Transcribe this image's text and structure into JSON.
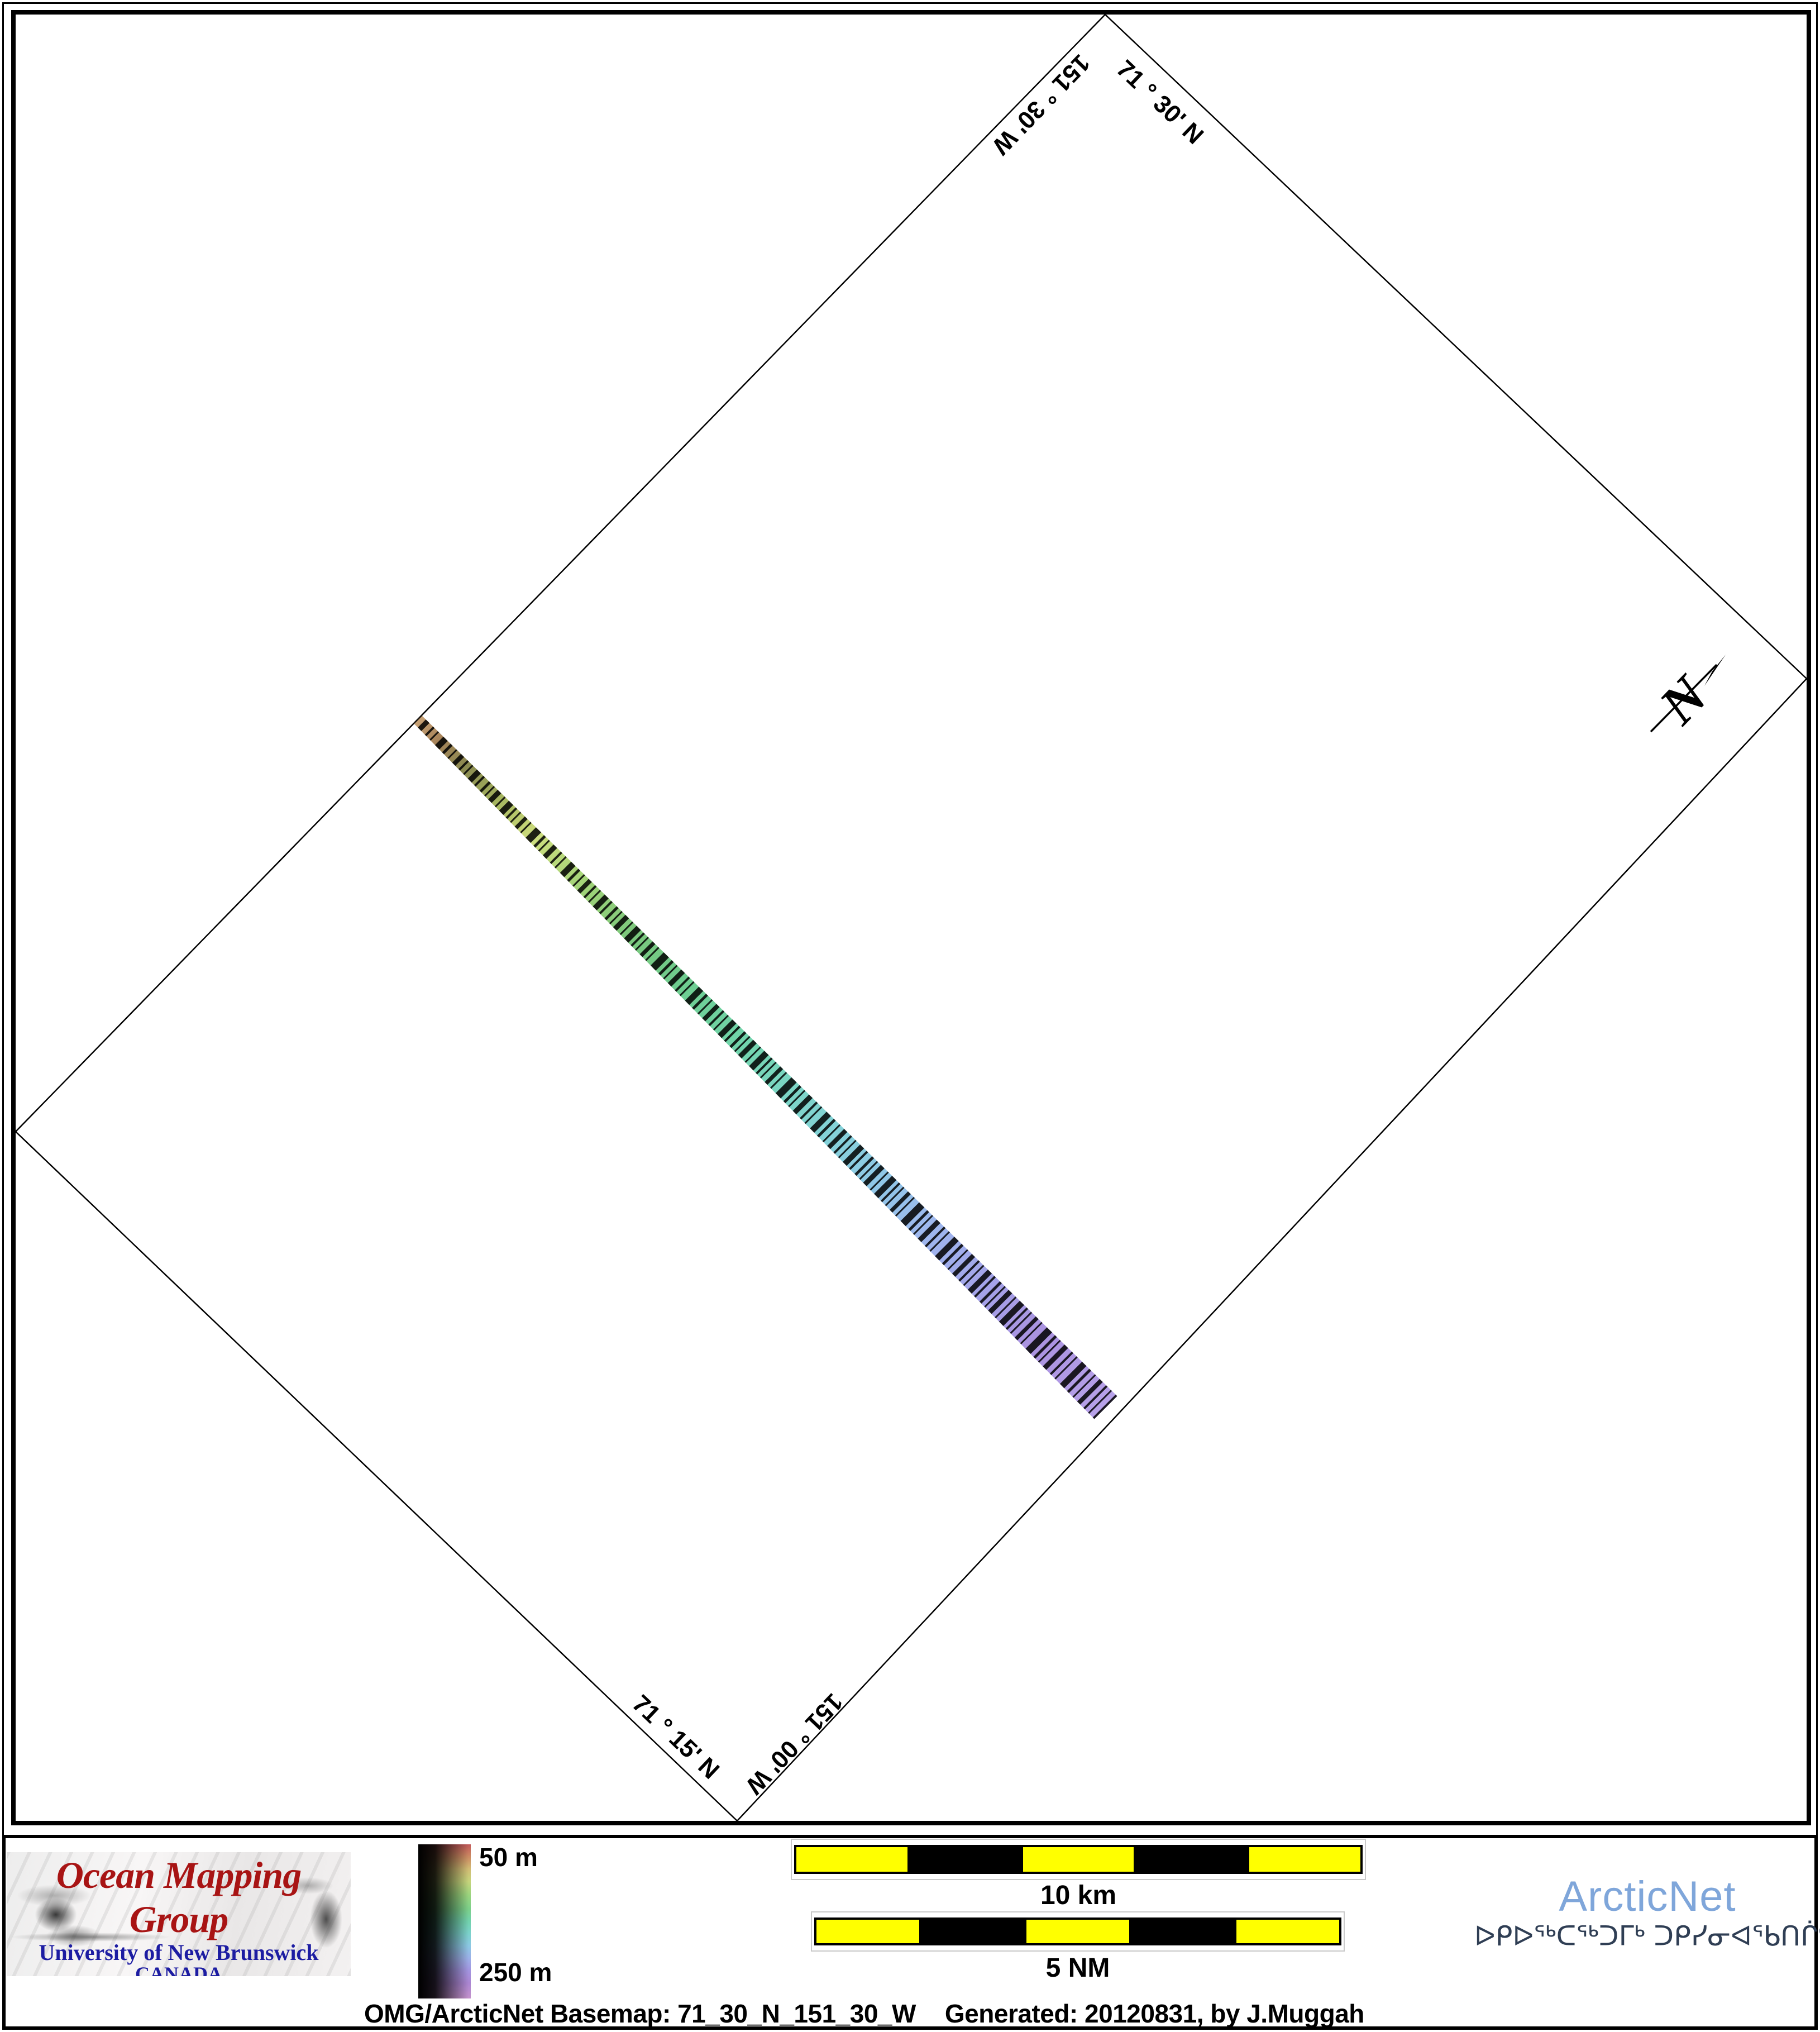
{
  "map": {
    "graticule_labels": {
      "top_left": "151 ° 30' W",
      "top_right": "71 ° 30' N",
      "bottom_left": "71 ° 15' N",
      "bottom_right": "151 ° 00' W"
    },
    "north_arrow_label": "N",
    "swath": {
      "description": "multibeam bathymetry swath",
      "colormap_along_track": [
        "#c8a276",
        "#8a8a50",
        "#cede7e",
        "#7cc87c",
        "#6ecc8e",
        "#70d4a8",
        "#7ad6c2",
        "#84d2d8",
        "#90c8e8",
        "#9eb8ee",
        "#a4a4ea",
        "#aa92e0",
        "#b8a2ea"
      ]
    }
  },
  "legend": {
    "top_label": "50 m",
    "bottom_label": "250 m",
    "colormap": [
      "#c25a5a",
      "#d2bc74",
      "#9ad47e",
      "#72d2ae",
      "#8cc8e4",
      "#9cb0e8",
      "#ab86d2",
      "#c492cc"
    ]
  },
  "scale_bars": [
    {
      "label": "10 km"
    },
    {
      "label": "5 NM"
    }
  ],
  "logos": {
    "omg": {
      "title": "Ocean Mapping Group",
      "line1": "University of New Brunswick",
      "line2": "CANADA",
      "title_color": "#a81414",
      "text_color": "#1c1ca2"
    },
    "arcticnet": {
      "name": "ArcticNet",
      "syllabics": "ᐅᑭᐅᖅᑕᖅᑐᒥᒃ ᑐᑭᓯᓂᐊᖃᑎᒌᑦ",
      "name_color": "#7fa6da",
      "syllabics_color": "#2f3e54"
    }
  },
  "caption": {
    "left": "OMG/ArcticNet Basemap: 71_30_N_151_30_W",
    "right": "Generated: 20120831, by J.Muggah"
  },
  "colors": {
    "scalebar_yellow": "#ffff00",
    "frame_black": "#000000"
  }
}
